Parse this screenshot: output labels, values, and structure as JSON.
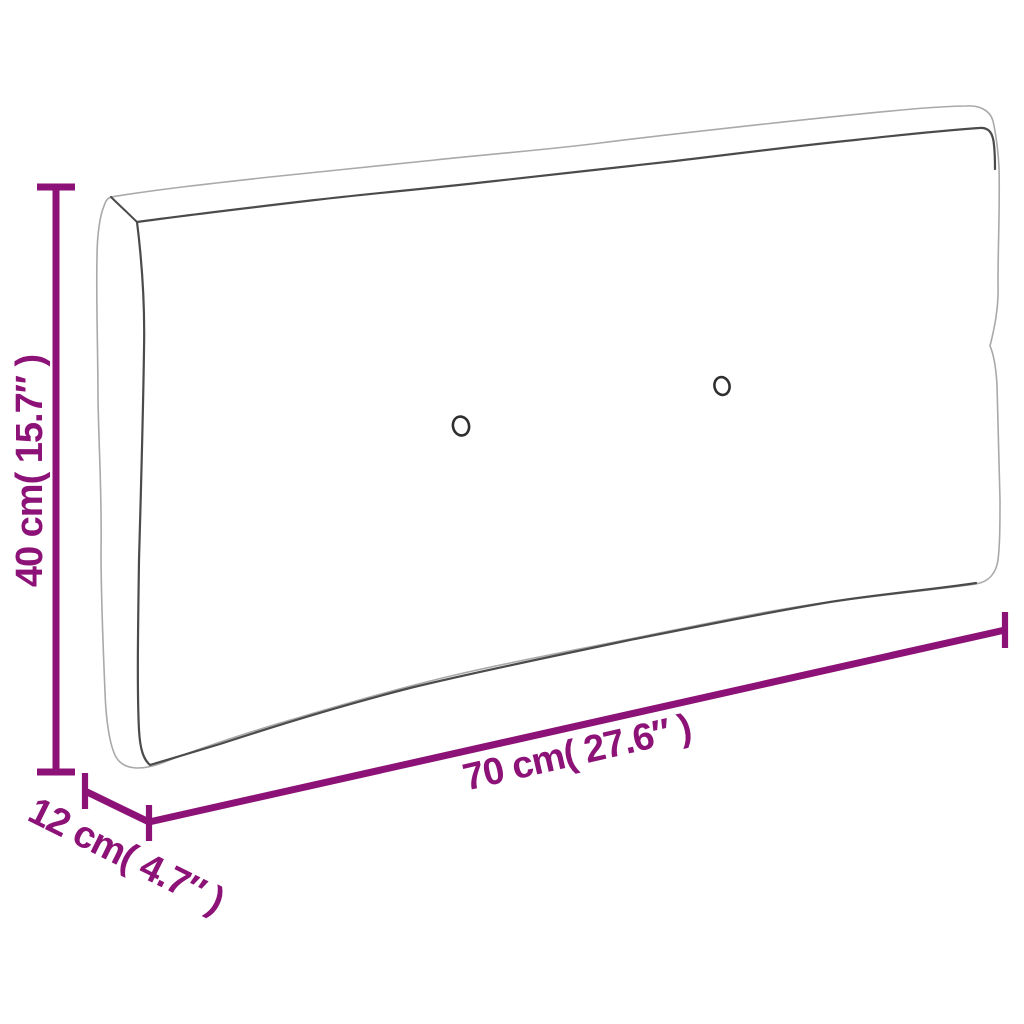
{
  "diagram": {
    "title": "pallet-cushion-dimension-diagram",
    "colors": {
      "background": "#ffffff",
      "accent": "#8D1277",
      "outer_outline": "#a9a9a9",
      "seam_outline": "#4b4b4b",
      "button_outline": "#2f2f2f"
    },
    "dimensions": [
      {
        "id": "height",
        "label": "40 cm( 15.7″ )"
      },
      {
        "id": "width",
        "label": "70 cm( 27.6″ )"
      },
      {
        "id": "depth",
        "label": "12 cm( 4.7″ )"
      }
    ]
  }
}
